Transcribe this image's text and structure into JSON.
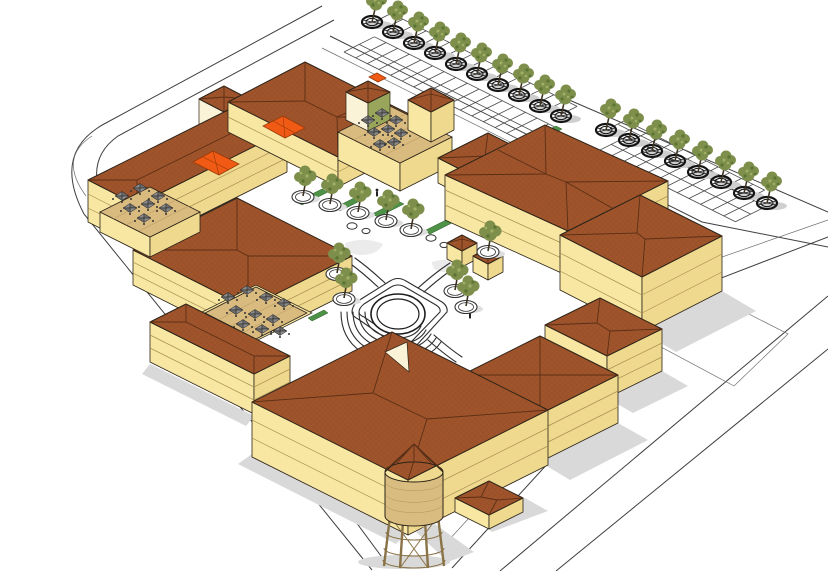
{
  "meta": {
    "type": "3d-architectural-massing-rendering",
    "view": "aerial-isometric",
    "background": "white"
  },
  "colors": {
    "bg": "#FFFFFF",
    "roof": "#A0542B",
    "roofline": "#5B2F16",
    "wallL": "#F7E7A2",
    "wallR": "#EFD98E",
    "wallD": "#E2C178",
    "cream": "#FBF3D8",
    "olive": "#9AA55C",
    "floorline": "#A98F52",
    "deck": "#D9BA7F",
    "deckline": "#B4955E",
    "awning": "#F05A14",
    "treeA": "#7D8F4B",
    "treeB": "#5C7434",
    "treeC": "#9FB066",
    "trunk": "#3E3424",
    "ring": "#141414",
    "road": "#3F3F3F",
    "stall": "#4A4A4A",
    "shadow": "#D9D9D9",
    "hedge": "#4E9247",
    "tank": "#D9BC80",
    "legs": "#8A7347",
    "outline": "#2B2318",
    "pathline": "#2E2E2E"
  },
  "scene": {
    "inventory": {
      "building_masses": 14,
      "street_trees_north_row": 10,
      "street_trees_east_row": 8,
      "plaza_trees": 10,
      "small_round_planters": 4,
      "umbrellas_terrace_west": 7,
      "umbrellas_terrace_courtyard": 10,
      "umbrellas_roof_terrace_north": 8,
      "orange_awnings": 3,
      "water_tower": 1,
      "corner_kiosk_building": 1,
      "plaza_kiosks": 2,
      "amphitheater": 1,
      "parking_stall_rows": 4
    },
    "materials": {
      "roofs": "terracotta hip roofs with crosshatch texture",
      "walls": "pale yellow stucco with floor lines",
      "plaza": "white paving with looped walkways and circular amphitheater"
    }
  }
}
